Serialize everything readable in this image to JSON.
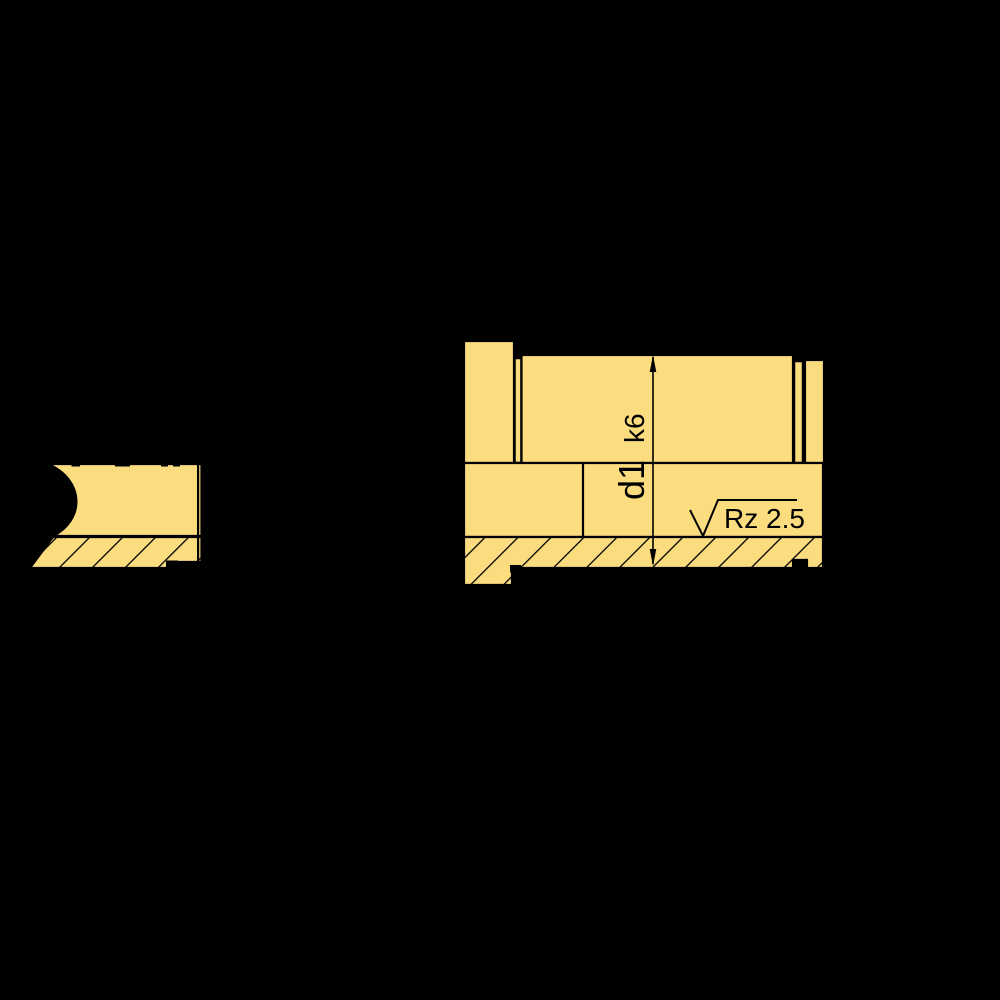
{
  "drawing": {
    "background_color": "#000000",
    "part_fill_color": "#FBDC7F",
    "line_color": "#000000",
    "dimension": {
      "diameter_label": "d1",
      "tolerance_label": "k6"
    },
    "surface_finish": {
      "label": "Rz 2.5"
    }
  }
}
